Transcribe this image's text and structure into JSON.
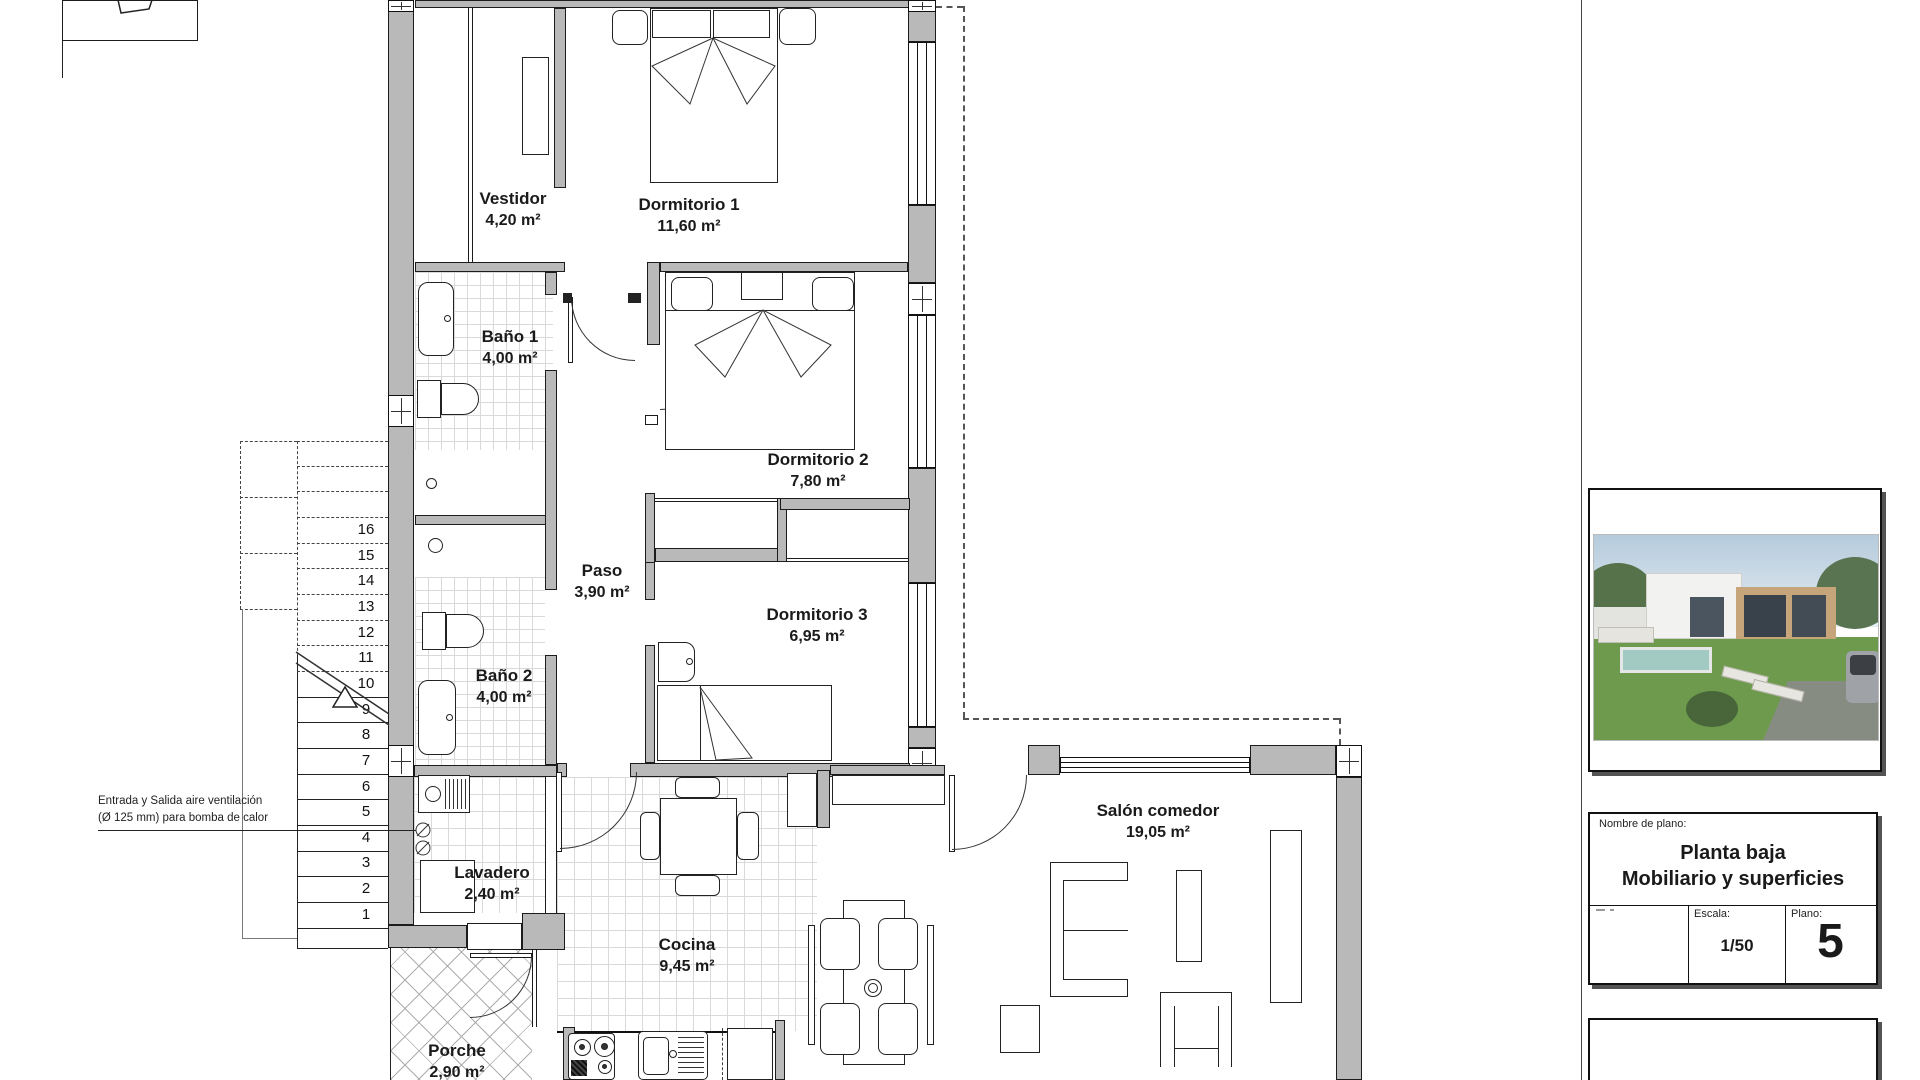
{
  "plan": {
    "rooms": {
      "vestidor": {
        "name": "Vestidor",
        "area": "4,20 m²"
      },
      "dormitorio1": {
        "name": "Dormitorio 1",
        "area": "11,60 m²"
      },
      "bano1": {
        "name": "Baño 1",
        "area": "4,00 m²"
      },
      "dormitorio2": {
        "name": "Dormitorio 2",
        "area": "7,80 m²"
      },
      "paso": {
        "name": "Paso",
        "area": "3,90 m²"
      },
      "dormitorio3": {
        "name": "Dormitorio 3",
        "area": "6,95 m²"
      },
      "bano2": {
        "name": "Baño 2",
        "area": "4,00 m²"
      },
      "lavadero": {
        "name": "Lavadero",
        "area": "2,40 m²"
      },
      "cocina": {
        "name": "Cocina",
        "area": "9,45 m²"
      },
      "salon": {
        "name": "Salón comedor",
        "area": "19,05 m²"
      },
      "porche": {
        "name": "Porche",
        "area": "2,90 m²"
      }
    },
    "annotation": {
      "line1": "Entrada y Salida aire ventilación",
      "line2": "(Ø 125 mm) para bomba de calor"
    },
    "stairs": {
      "numbers": [
        "16",
        "15",
        "14",
        "13",
        "12",
        "11",
        "10",
        "9",
        "8",
        "7",
        "6",
        "5",
        "4",
        "3",
        "2",
        "1"
      ]
    }
  },
  "title_block": {
    "name_label": "Nombre de plano:",
    "plan_title_line1": "Planta baja",
    "plan_title_line2": "Mobiliario y superficies",
    "escala_label": "Escala:",
    "escala_value": "1/50",
    "plano_label": "Plano:",
    "plano_value": "5"
  },
  "colors": {
    "wall_fill": "#b9b9b9",
    "grass": "#6d9a4c",
    "pool": "#a3c9c3",
    "wood_facade": "#c7a57a"
  }
}
